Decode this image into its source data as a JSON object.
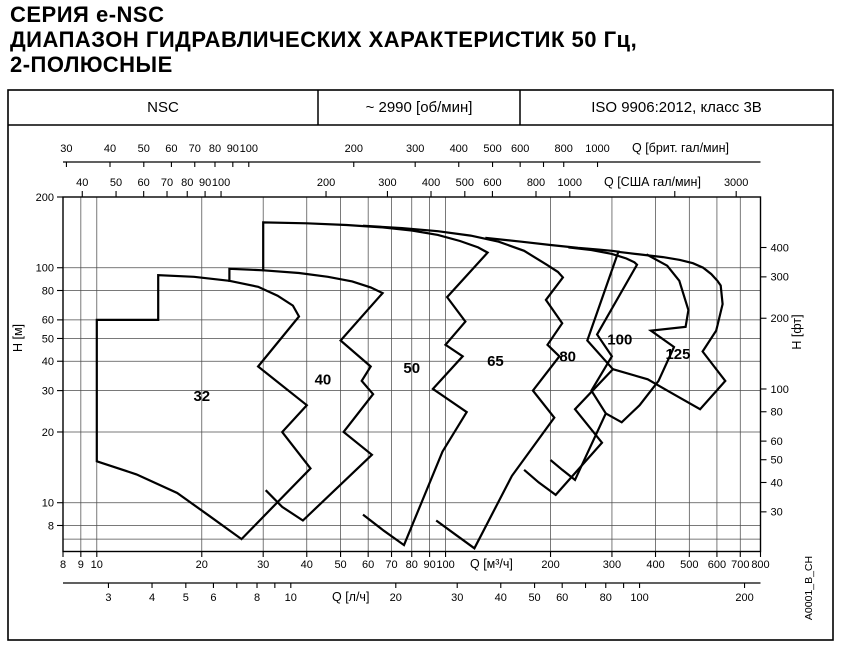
{
  "title": {
    "line1": "СЕРИЯ e-NSC",
    "line2": "ДИАПАЗОН ГИДРАВЛИЧЕСКИХ ХАРАКТЕРИСТИК 50 Гц,",
    "line3": "2-ПОЛЮСНЫЕ"
  },
  "header": {
    "series": "NSC",
    "speed": "~ 2990 [об/мин]",
    "standard": "ISO 9906:2012, класс 3В"
  },
  "watermark": "A0001_B_CH",
  "colors": {
    "line": "#000000",
    "grid": "#4d4d4d",
    "background": "#ffffff"
  },
  "chart_data": {
    "type": "area",
    "title": "Диапазон гидравлических характеристик, 50 Гц, 2-полюсные, ~2990 об/мин",
    "layout": {
      "frame": [
        8,
        90,
        833,
        640
      ],
      "header_row_bottom": 125,
      "header_dividers": [
        318,
        520
      ],
      "plot": {
        "x0": 63,
        "x1": 760.5,
        "y_top": 197,
        "y_bot": 551.5,
        "qmin": 8,
        "qmax": 800,
        "hmin": 6.2,
        "hmax": 200
      },
      "grid_on": true
    },
    "grid": {
      "x_m3h": [
        9,
        10,
        20,
        30,
        40,
        50,
        60,
        70,
        80,
        90,
        100,
        200,
        300,
        400,
        500,
        600,
        700
      ],
      "y_m": [
        7,
        8,
        10,
        20,
        30,
        40,
        50,
        60,
        80,
        100
      ]
    },
    "x_axes": [
      {
        "id": "imp-gpm",
        "unit_label": "Q [брит. гал/мин]",
        "factor_to_m3h": 0.27277,
        "line_y": 162,
        "tick_len": 5,
        "label_y": 152,
        "title_x": 632,
        "ticks": [
          30,
          40,
          50,
          60,
          70,
          80,
          90,
          100,
          200,
          300,
          400,
          500,
          600,
          800,
          1000
        ],
        "minor": [
          700
        ],
        "draw_line": true
      },
      {
        "id": "usa-gpm",
        "unit_label": "Q [США гал/мин]",
        "factor_to_m3h": 0.22712,
        "line_y": 197,
        "tick_len": -6,
        "label_y": 186,
        "title_x": 604,
        "ticks": [
          40,
          50,
          60,
          70,
          80,
          90,
          100,
          200,
          300,
          400,
          500,
          600,
          800,
          1000,
          3000
        ],
        "minor": [
          2000
        ],
        "draw_line": false
      },
      {
        "id": "m3h",
        "unit_label": "Q [м³/ч]",
        "factor_to_m3h": 1,
        "line_y": 551.5,
        "tick_len": 5.5,
        "label_y": 568,
        "title_x": 470,
        "ticks": [
          8,
          9,
          10,
          20,
          30,
          40,
          50,
          60,
          70,
          80,
          90,
          100,
          200,
          300,
          400,
          500,
          600,
          700,
          800
        ],
        "minor": [],
        "draw_line": false
      },
      {
        "id": "ls",
        "unit_label": "Q [л/ч]",
        "factor_to_m3h": 3.6,
        "line_y": 583,
        "tick_len": 5,
        "label_y": 601,
        "title_x": 332,
        "ticks": [
          3,
          4,
          5,
          6,
          8,
          10,
          20,
          30,
          40,
          50,
          60,
          80,
          100,
          200
        ],
        "minor": [
          7,
          9,
          70,
          90
        ],
        "draw_line": true
      }
    ],
    "y_axes": [
      {
        "id": "h-m",
        "unit_label": "H [м]",
        "factor_to_m": 1,
        "side": "left",
        "ticks": [
          200,
          100,
          80,
          60,
          50,
          40,
          30,
          20,
          10,
          8
        ],
        "title_pos": [
          22,
          338
        ]
      },
      {
        "id": "h-ft",
        "unit_label": "H [фт]",
        "factor_to_m": 0.3048,
        "side": "right",
        "ticks": [
          400,
          300,
          200,
          100,
          80,
          60,
          50,
          40,
          30
        ],
        "title_pos": [
          801,
          332
        ]
      }
    ],
    "size_labels": [
      {
        "text": "32",
        "q": 20,
        "h": 28.5
      },
      {
        "text": "40",
        "q": 44.5,
        "h": 33.5
      },
      {
        "text": "50",
        "q": 80,
        "h": 37.5
      },
      {
        "text": "65",
        "q": 139,
        "h": 40
      },
      {
        "text": "80",
        "q": 224,
        "h": 42
      },
      {
        "text": "100",
        "q": 316,
        "h": 49.5
      },
      {
        "text": "125",
        "q": 464,
        "h": 43
      }
    ],
    "envelopes": [
      {
        "name": "envelope-32",
        "closed": true,
        "points": [
          [
            10,
            15
          ],
          [
            10,
            60
          ],
          [
            15,
            60
          ],
          [
            15,
            93
          ],
          [
            19,
            91.5
          ],
          [
            24,
            88
          ],
          [
            29,
            83
          ],
          [
            33,
            76
          ],
          [
            36.5,
            69
          ],
          [
            38,
            62
          ],
          [
            29,
            38
          ],
          [
            40,
            26
          ],
          [
            34,
            20
          ],
          [
            41,
            14
          ],
          [
            26,
            7
          ],
          [
            21,
            8.8
          ],
          [
            17,
            11
          ],
          [
            13,
            13.2
          ]
        ]
      },
      {
        "name": "envelope-40",
        "closed": false,
        "points": [
          [
            24,
            87
          ],
          [
            24,
            99
          ],
          [
            30,
            97.5
          ],
          [
            38,
            95
          ],
          [
            46,
            91.5
          ],
          [
            54,
            87.5
          ],
          [
            61,
            82.5
          ],
          [
            66,
            78
          ],
          [
            50,
            49
          ],
          [
            61,
            38
          ],
          [
            57.5,
            33
          ],
          [
            62,
            29
          ],
          [
            51,
            20
          ],
          [
            61.5,
            16
          ],
          [
            39,
            8.4
          ],
          [
            34,
            9.6
          ],
          [
            30.5,
            11.3
          ]
        ]
      },
      {
        "name": "envelope-50",
        "closed": false,
        "points": [
          [
            30,
            96.5
          ],
          [
            30,
            156
          ],
          [
            40,
            154.5
          ],
          [
            52,
            152
          ],
          [
            66,
            148.5
          ],
          [
            80,
            144
          ],
          [
            95,
            138
          ],
          [
            110,
            130
          ],
          [
            124,
            122
          ],
          [
            132,
            116
          ],
          [
            101,
            75
          ],
          [
            114,
            59
          ],
          [
            100,
            47
          ],
          [
            112,
            42
          ],
          [
            92,
            30.5
          ],
          [
            115,
            24.3
          ],
          [
            98,
            16.5
          ],
          [
            76,
            6.6
          ],
          [
            66.5,
            7.6
          ],
          [
            58,
            8.9
          ]
        ]
      },
      {
        "name": "envelope-65",
        "closed": false,
        "points": [
          [
            58,
            151
          ],
          [
            75,
            147.5
          ],
          [
            95,
            143
          ],
          [
            118,
            137
          ],
          [
            142,
            129
          ],
          [
            168,
            118
          ],
          [
            195,
            103
          ],
          [
            210,
            96
          ],
          [
            217,
            91
          ],
          [
            194,
            73
          ],
          [
            216,
            58
          ],
          [
            196,
            47
          ],
          [
            212,
            42
          ],
          [
            178,
            30
          ],
          [
            205,
            23
          ],
          [
            155,
            13
          ],
          [
            121,
            6.4
          ],
          [
            107,
            7.3
          ],
          [
            94,
            8.4
          ]
        ]
      },
      {
        "name": "envelope-80",
        "closed": false,
        "points": [
          [
            130,
            134
          ],
          [
            165,
            129
          ],
          [
            200,
            125
          ],
          [
            240,
            121.5
          ],
          [
            275,
            119.5
          ],
          [
            300,
            118
          ],
          [
            313,
            117
          ],
          [
            255,
            49
          ],
          [
            302,
            37
          ],
          [
            235,
            25
          ],
          [
            281,
            18
          ],
          [
            207,
            10.8
          ],
          [
            185,
            12.2
          ],
          [
            168,
            13.8
          ]
        ]
      },
      {
        "name": "envelope-100",
        "closed": false,
        "points": [
          [
            225,
            122
          ],
          [
            262,
            119
          ],
          [
            300,
            114.5
          ],
          [
            330,
            109.5
          ],
          [
            348,
            105.5
          ],
          [
            354,
            103
          ],
          [
            272,
            52
          ],
          [
            300,
            42
          ],
          [
            262,
            30
          ],
          [
            288,
            24
          ],
          [
            235,
            12.5
          ],
          [
            216,
            13.8
          ],
          [
            200,
            15.2
          ]
        ]
      },
      {
        "name": "envelope-125-left-boundary",
        "closed": false,
        "points": [
          [
            377,
            114
          ],
          [
            432,
            102
          ],
          [
            468,
            88
          ],
          [
            497,
            66
          ],
          [
            488,
            56
          ],
          [
            388,
            54
          ],
          [
            452,
            46
          ],
          [
            408,
            33
          ],
          [
            360,
            26
          ],
          [
            320,
            22
          ],
          [
            288,
            24
          ]
        ]
      },
      {
        "name": "envelope-125",
        "closed": false,
        "points": [
          [
            310,
            117
          ],
          [
            360,
            114
          ],
          [
            420,
            111
          ],
          [
            470,
            108
          ],
          [
            512,
            104.5
          ],
          [
            548,
            100
          ],
          [
            578,
            94
          ],
          [
            602,
            88
          ],
          [
            615,
            84
          ],
          [
            623,
            70
          ],
          [
            597,
            54
          ],
          [
            546,
            44
          ],
          [
            634,
            33
          ],
          [
            537,
            25
          ],
          [
            450,
            29
          ],
          [
            380,
            33.5
          ],
          [
            302,
            37
          ]
        ]
      }
    ]
  }
}
